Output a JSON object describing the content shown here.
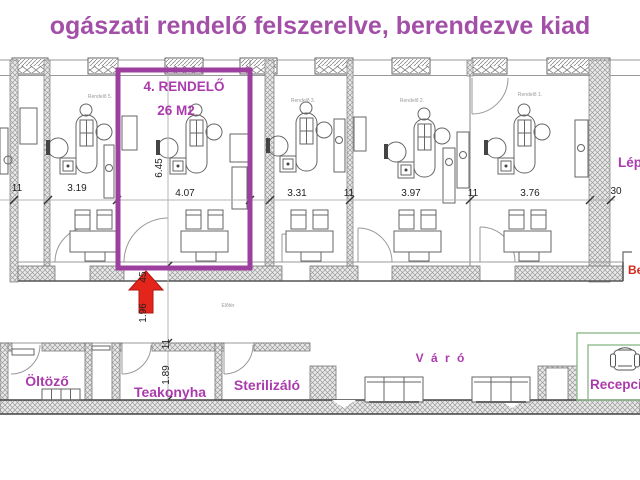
{
  "title": "ogászati rendelő felszerelve, berendezve kiad",
  "highlight_room": {
    "name": "4. RENDELŐ",
    "area": "26 M2"
  },
  "plan": {
    "top_room_labels": [
      "Rendelő 5.",
      "Rendelő 3.",
      "Rendelő 2.",
      "Rendelő 1."
    ],
    "dims_top": [
      "11",
      "3.19",
      "4.07",
      "3.31",
      "11",
      "3.97",
      "11",
      "3.76",
      "30"
    ],
    "dims_side": [
      "6.45",
      "45",
      "1.96",
      "11",
      "1.89"
    ],
    "corridor_label": "Előtér",
    "lower_rooms": {
      "dressing": "Öltöző",
      "kitchen": "Teakonyha",
      "sterilizer": "Sterilizáló"
    },
    "waiting_label": "V á r ó",
    "reception_label": "Recepció",
    "stairs_label": "Lépcső",
    "entrance_label": "Bejárat"
  },
  "colors": {
    "title_magenta": "#a34fa8",
    "label_magenta": "#ab3bad",
    "highlight_box_purple": "#9c3f9f",
    "arrow_red": "#e3251c",
    "entrance_red": "#d6281e",
    "reception_green": "#8fbc8f"
  }
}
